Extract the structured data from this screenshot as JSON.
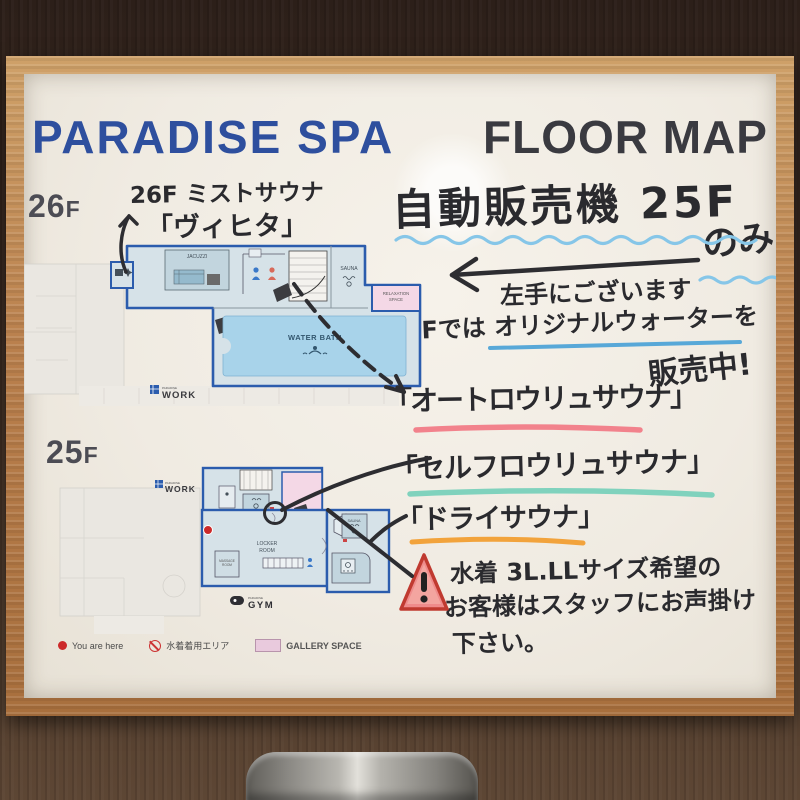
{
  "scene": {
    "wall_color": "#3a2a21",
    "frame_color": "#b97f4c",
    "paper_color": "#f0ebe2",
    "trashcan": "stainless-steel-bin"
  },
  "poster": {
    "title": {
      "part1": "PARADISE SPA",
      "part2": "FLOOR MAP",
      "color1": "#2e4f9e",
      "color2": "#3a3a40"
    },
    "map26": {
      "label_num": "26",
      "label_f": "F",
      "note1": "26F ミストサウナ",
      "note2": "「ヴィヒタ」",
      "rooms": {
        "jacuzzi": "JACUZZI",
        "sauna": "SAUNA",
        "relaxation1": "RELAXATION",
        "relaxation2": "SPACE",
        "water_bath": "WATER BATH",
        "work_brand": "PARADISE",
        "work": "WORK"
      }
    },
    "map25": {
      "label_num": "25",
      "label_f": "F",
      "rooms": {
        "work_brand": "PARADISE",
        "work": "WORK",
        "locker1": "LOCKER",
        "locker2": "ROOM",
        "massage1": "MASSAGE",
        "massage2": "ROOM",
        "sauna_right": "SAUNA",
        "gym_brand": "PARADISE",
        "gym": "GYM"
      }
    },
    "notes": {
      "vending": "自動販売機 25F",
      "only": "のみ",
      "left_hand": "左手にございます",
      "water_line": "26Fでは オリジナルウォーターを",
      "on_sale": "販売中!",
      "sauna_auto": "「オートロウリュサウナ」",
      "sauna_self": "「セルフロウリュサウナ」",
      "sauna_dry": "「ドライサウナ」",
      "warning1": "水着 3L.LLサイズ希望の",
      "warning2": "お客様はスタッフにお声掛け",
      "warning3": "下さい。"
    },
    "legend": {
      "you_are_here": "You are here",
      "swimwear_area": "水着着用エリア",
      "gallery_space": "GALLERY SPACE"
    },
    "colors": {
      "underline_wave_blue": "#86c6e8",
      "underline_water_blue": "#58a8d8",
      "underline_pink": "#f2828c",
      "underline_teal": "#80d2bd",
      "underline_orange": "#f2a33c",
      "marker_black": "#2d2d31",
      "plan_outline_blue": "#2b5cad",
      "pool_blue": "#a8d3ea",
      "gallery_pink": "#f4d8e6",
      "warning_red": "#e2574b"
    }
  }
}
